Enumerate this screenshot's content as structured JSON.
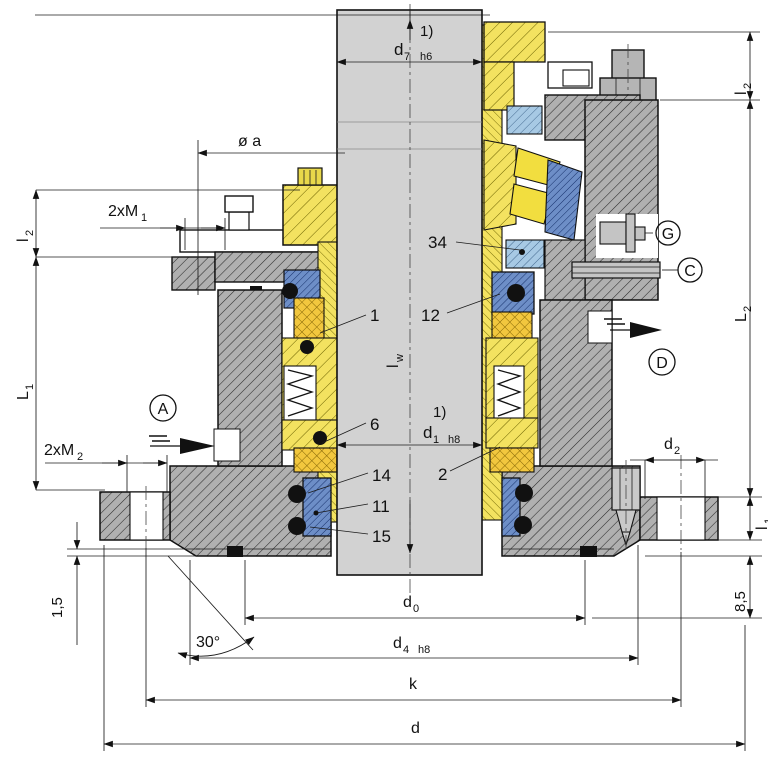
{
  "labels": {
    "note": "1)",
    "d7_base": "d",
    "d7_sub": "7",
    "d7_tol": "h6",
    "dia_a": "ø a",
    "m1_base": "2xM",
    "m1_sub": "1",
    "l2_base": "l",
    "l2_sub": "2",
    "L1_base": "L",
    "L1_sub": "1",
    "m2_base": "2xM",
    "m2_sub": "2",
    "lw_base": "l",
    "lw_sub": "w",
    "d1_base": "d",
    "d1_sub": "1",
    "d1_tol": "h8",
    "L2_base": "L",
    "L2_sub": "2",
    "d2_base": "d",
    "d2_sub": "2",
    "l1_base": "l",
    "l1_sub": "1",
    "dim85": "8,5",
    "dim15": "1,5",
    "angle30": "30°",
    "d0_base": "d",
    "d0_sub": "0",
    "d4_base": "d",
    "d4_sub": "4",
    "d4_tol": "h8",
    "k": "k",
    "d": "d"
  },
  "ports": {
    "A": "A",
    "C": "C",
    "D": "D",
    "G": "G"
  },
  "parts": {
    "n1": "1",
    "n2": "2",
    "n6": "6",
    "n11": "11",
    "n12": "12",
    "n14": "14",
    "n15": "15",
    "n34": "34"
  },
  "colors": {
    "steel_gray": "#b0b0b0",
    "shaft_gray": "#d2d2d2",
    "brass_yellow": "#f3e260",
    "elastomer_orange": "#f2c73e",
    "seal_blue": "#6d8ec7",
    "light_blue": "#a7c9e4",
    "line_black": "#111111"
  }
}
